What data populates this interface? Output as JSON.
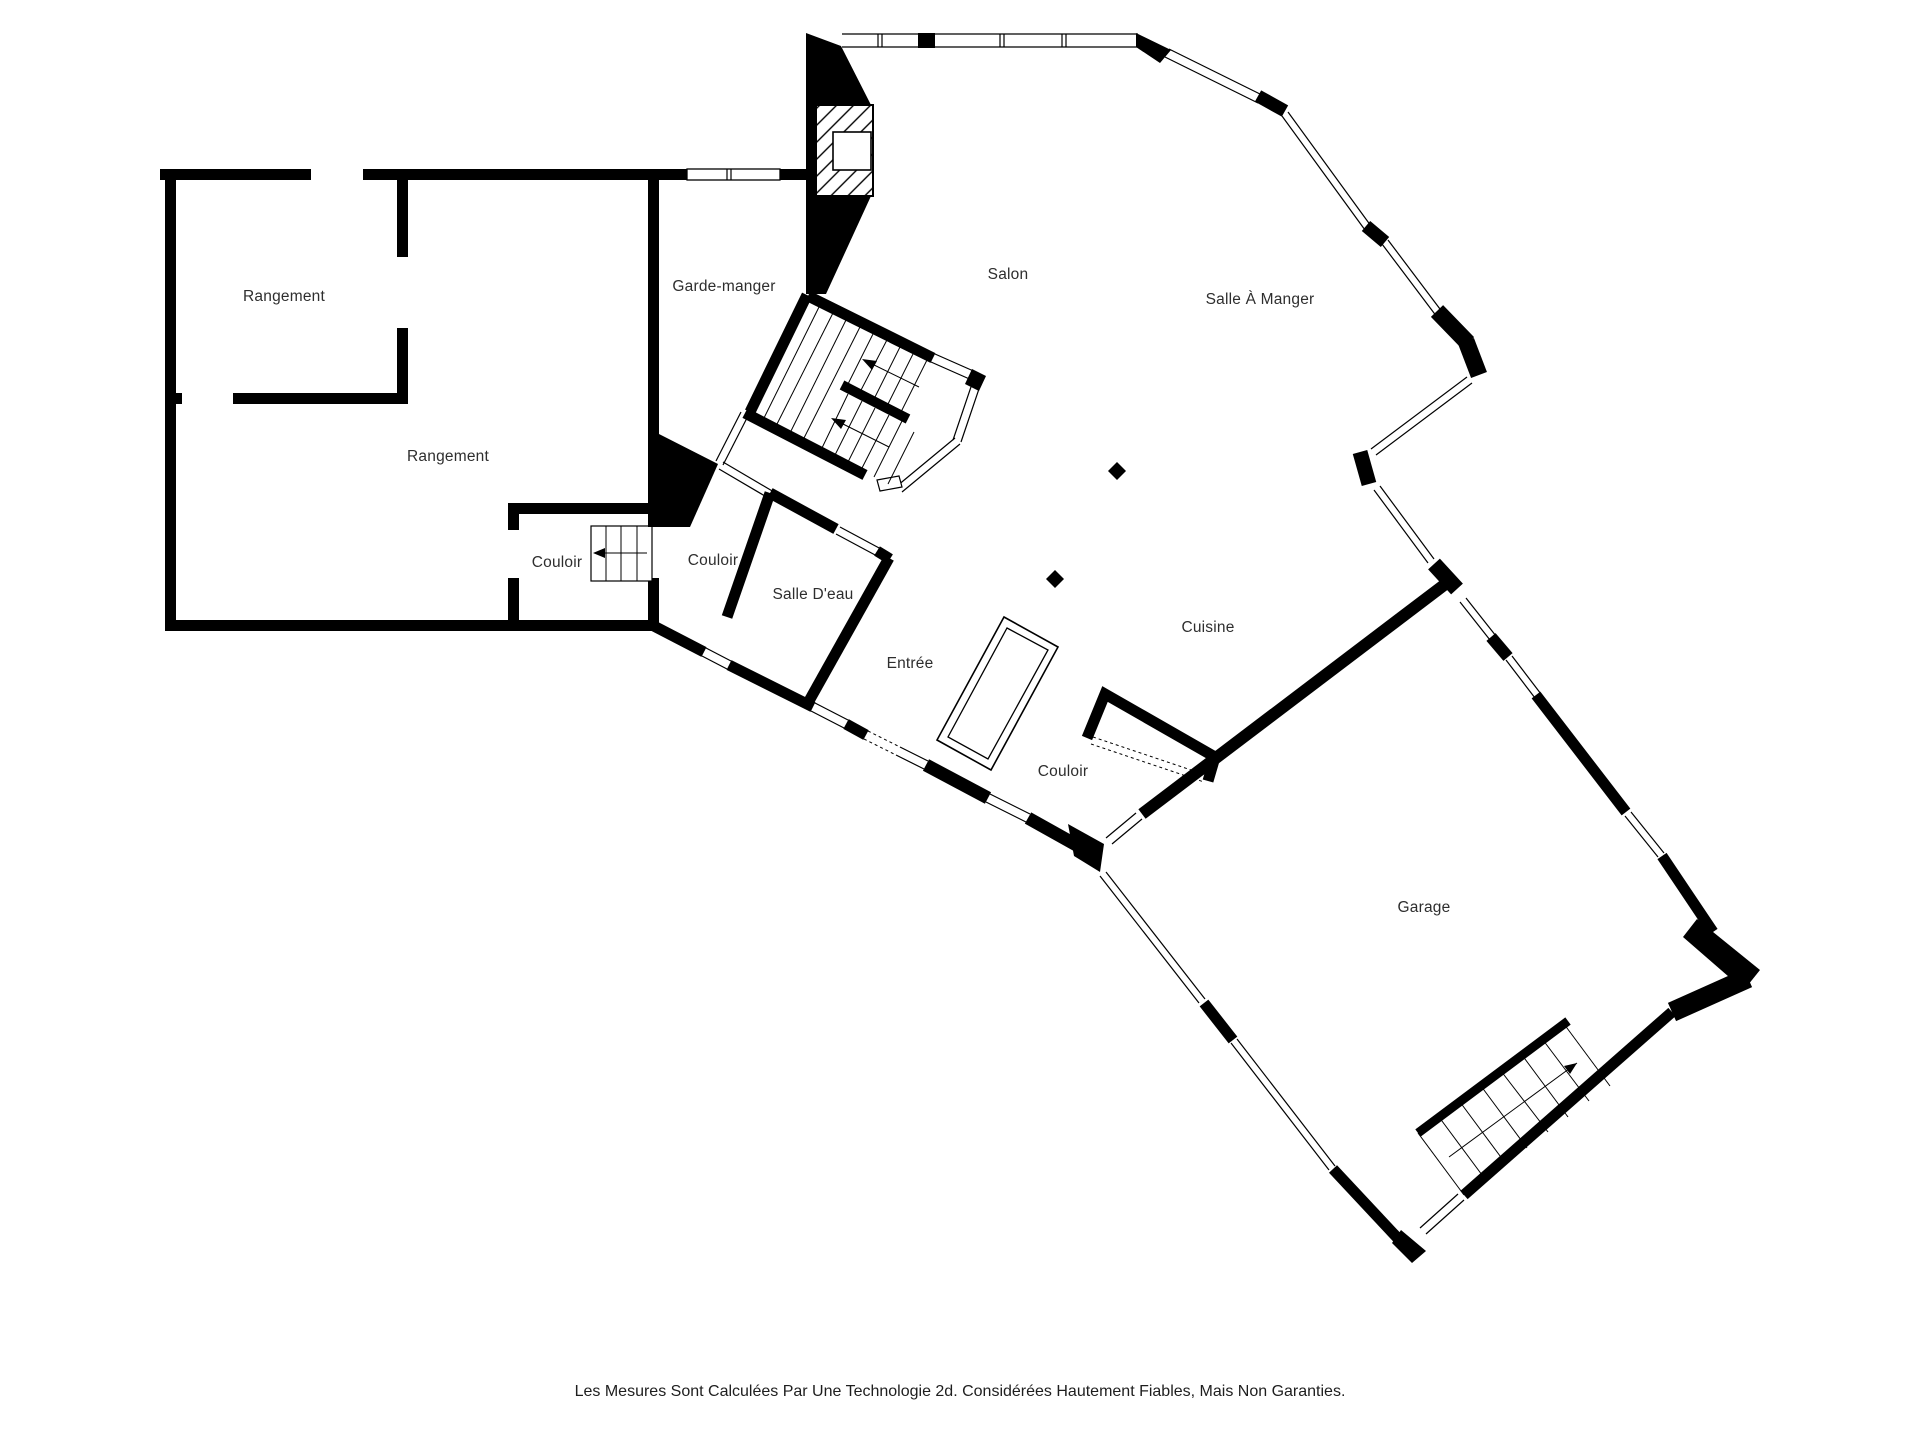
{
  "floorplan": {
    "labels": {
      "rangement_top": "Rangement",
      "rangement_main": "Rangement",
      "garde_manger": "Garde-manger",
      "salon": "Salon",
      "salle_a_manger": "Salle À Manger",
      "couloir_ouest": "Couloir",
      "couloir_centre": "Couloir",
      "salle_deau": "Salle D'eau",
      "entree": "Entrée",
      "cuisine": "Cuisine",
      "couloir_est": "Couloir",
      "garage": "Garage"
    },
    "disclaimer": "Les Mesures Sont Calculées Par Une Technologie 2d. Considérées Hautement Fiables, Mais Non Garanties.",
    "colors": {
      "walls": "#000000",
      "text": "#2e2e2e",
      "background": "#ffffff"
    }
  }
}
